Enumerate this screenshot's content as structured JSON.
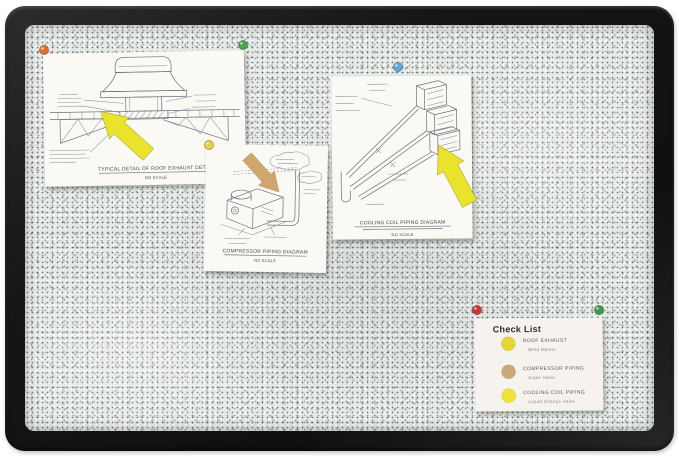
{
  "board": {
    "frame_color": "#1a1a1a",
    "surface_color": "#e6eae7"
  },
  "papers": [
    {
      "title": "TYPICAL DETAIL OF ROOF EXHAUST DETAIL",
      "subtitle": "NO SCALE"
    },
    {
      "title": "COMPRESSOR PIPING DIAGRAM",
      "subtitle": "NO SCALE"
    },
    {
      "title": "COOLING COIL PIPING DIAGRAM",
      "subtitle": "NO SCALE"
    }
  ],
  "arrows": [
    {
      "name": "yellow-arrow-roof-exhaust",
      "color": "#e9e32b"
    },
    {
      "name": "tan-arrow-compressor",
      "color": "#cfa76e"
    },
    {
      "name": "yellow-arrow-cooling-coil",
      "color": "#e9e32b"
    }
  ],
  "pins": [
    {
      "name": "pin-orange",
      "color": "#e0702f"
    },
    {
      "name": "pin-green",
      "color": "#4aa44c"
    },
    {
      "name": "pin-yellow",
      "color": "#e3d43b"
    },
    {
      "name": "pin-blue",
      "color": "#5ba9d8"
    },
    {
      "name": "pin-red",
      "color": "#cd3531"
    },
    {
      "name": "pin-green-2",
      "color": "#3f9b48"
    }
  ],
  "checklist": {
    "title": "Check List",
    "items": [
      {
        "label": "ROOF EXHAUST",
        "sublabel": "Wind Master",
        "dot_color": "#e4d839"
      },
      {
        "label": "COMPRESSOR PIPING",
        "sublabel": "Angle Valve",
        "dot_color": "#cba87c"
      },
      {
        "label": "COOLING COIL PIPING",
        "sublabel": "Liquid Change Valve",
        "dot_color": "#efe42f"
      }
    ]
  }
}
